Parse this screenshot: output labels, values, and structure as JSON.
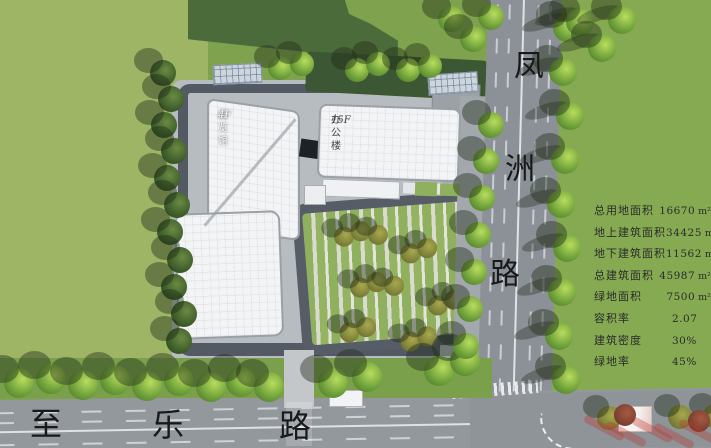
{
  "roads": {
    "vertical": {
      "name": "凤洲路",
      "chars": [
        "凤",
        "洲",
        "路"
      ]
    },
    "horizontal": {
      "name": "至乐路",
      "chars": [
        "至",
        "乐",
        "路"
      ]
    }
  },
  "site": {
    "buildings": [
      {
        "name": "展览馆",
        "floors": "4F"
      },
      {
        "name": "办公楼",
        "floors": "15F"
      }
    ]
  },
  "stats": {
    "rows": [
      {
        "label": "总用地面积",
        "value": "16670",
        "unit": "m²"
      },
      {
        "label": "地上建筑面积",
        "value": "34425",
        "unit": "m²"
      },
      {
        "label": "地下建筑面积",
        "value": "11562",
        "unit": "m²"
      },
      {
        "label": "总建筑面积",
        "value": "45987",
        "unit": "m²"
      },
      {
        "label": "绿地面积",
        "value": "7500",
        "unit": "m²"
      },
      {
        "label": "容积率",
        "value": "2.07",
        "unit": ""
      },
      {
        "label": "建筑密度",
        "value": "30%",
        "unit": ""
      },
      {
        "label": "绿地率",
        "value": "45%",
        "unit": ""
      }
    ]
  },
  "colors": {
    "grass_light": "#9eb566",
    "grass_mid": "#7ea24d",
    "grass_right": "#85aa52",
    "road": "#8c9197",
    "inner_road": "#545a64",
    "building": "#f3f4f5",
    "stripe_green": "#8fb05c",
    "text": "#2b2b2b"
  }
}
